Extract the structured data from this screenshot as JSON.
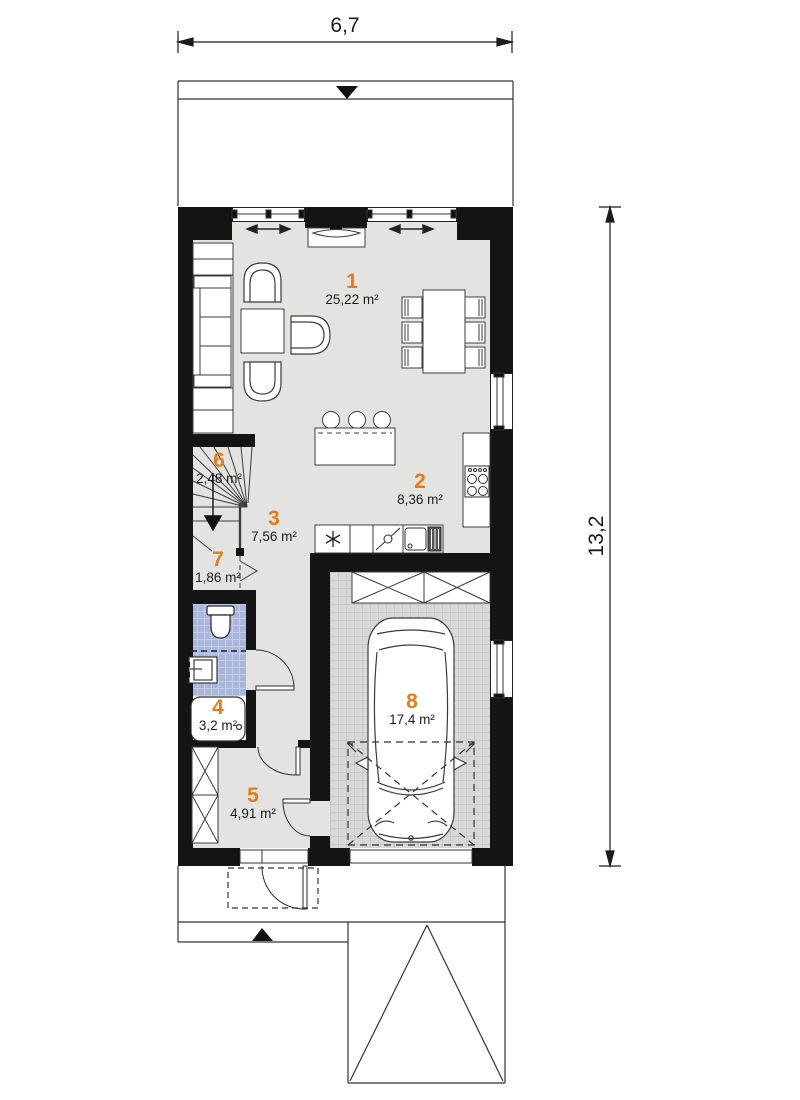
{
  "plan": {
    "dimensions": {
      "width_label": "6,7",
      "height_label": "13,2"
    },
    "rooms": [
      {
        "number": "1",
        "area": "25,22 m²"
      },
      {
        "number": "2",
        "area": "8,36 m²"
      },
      {
        "number": "3",
        "area": "7,56 m²"
      },
      {
        "number": "4",
        "area": "3,2 m²"
      },
      {
        "number": "5",
        "area": "4,91 m²"
      },
      {
        "number": "6",
        "area": "2,48 m²"
      },
      {
        "number": "7",
        "area": "1,86 m²"
      },
      {
        "number": "8",
        "area": "17,4 m²"
      }
    ],
    "colors": {
      "accent": "#ea7a18",
      "wall": "#141414",
      "floor": "#e3e3e2",
      "bath_tile": "#a9b7db",
      "garage_tile": "#d8d8d8"
    },
    "symbols": [
      "sofa",
      "armchair",
      "coffee-table",
      "dining-table",
      "dining-chair",
      "tv-cabinet",
      "kitchen-island",
      "bar-stool",
      "cooktop",
      "kitchen-sink",
      "dishwasher",
      "fridge",
      "staircase",
      "toilet",
      "washbasin",
      "shower-tray",
      "wardrobe",
      "storage-cabinet",
      "car",
      "door-swing",
      "window",
      "dimension-line",
      "driveway",
      "entry-arrow"
    ]
  }
}
